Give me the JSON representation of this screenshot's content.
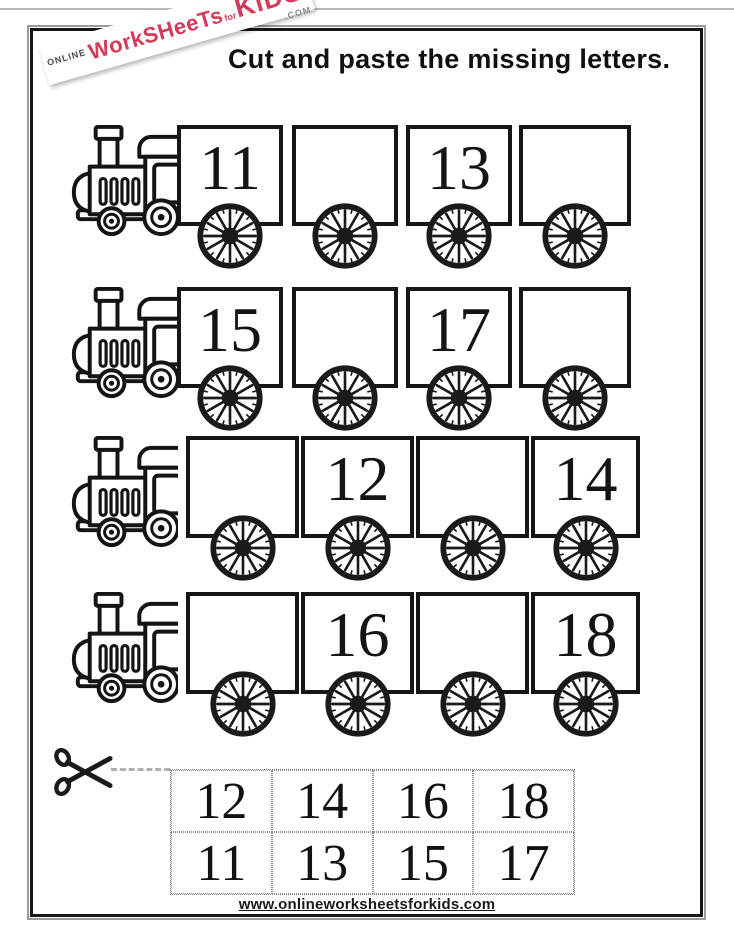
{
  "worksheet": {
    "title": "Cut and paste the missing letters.",
    "footer_url": "www.onlineworksheetsforkids.com"
  },
  "logo": {
    "online": "ONLINE",
    "main": "WorkSHeeTs",
    "sep": "for",
    "kids": "KiDS",
    "tld": ".COM",
    "accent_color": "#d23b5a"
  },
  "trains": [
    {
      "wagons": [
        "11",
        "",
        "13",
        ""
      ]
    },
    {
      "wagons": [
        "15",
        "",
        "17",
        ""
      ]
    },
    {
      "wagons": [
        "",
        "12",
        "",
        "14"
      ]
    },
    {
      "wagons": [
        "",
        "16",
        "",
        "18"
      ]
    }
  ],
  "cut_tiles": {
    "rows": [
      [
        "12",
        "14",
        "16",
        "18"
      ],
      [
        "11",
        "13",
        "15",
        "17"
      ]
    ]
  },
  "icons": {
    "locomotive": "steam-train-clipart",
    "wheel": "spoked-wagon-wheel",
    "scissors": "cut-here-scissors"
  }
}
